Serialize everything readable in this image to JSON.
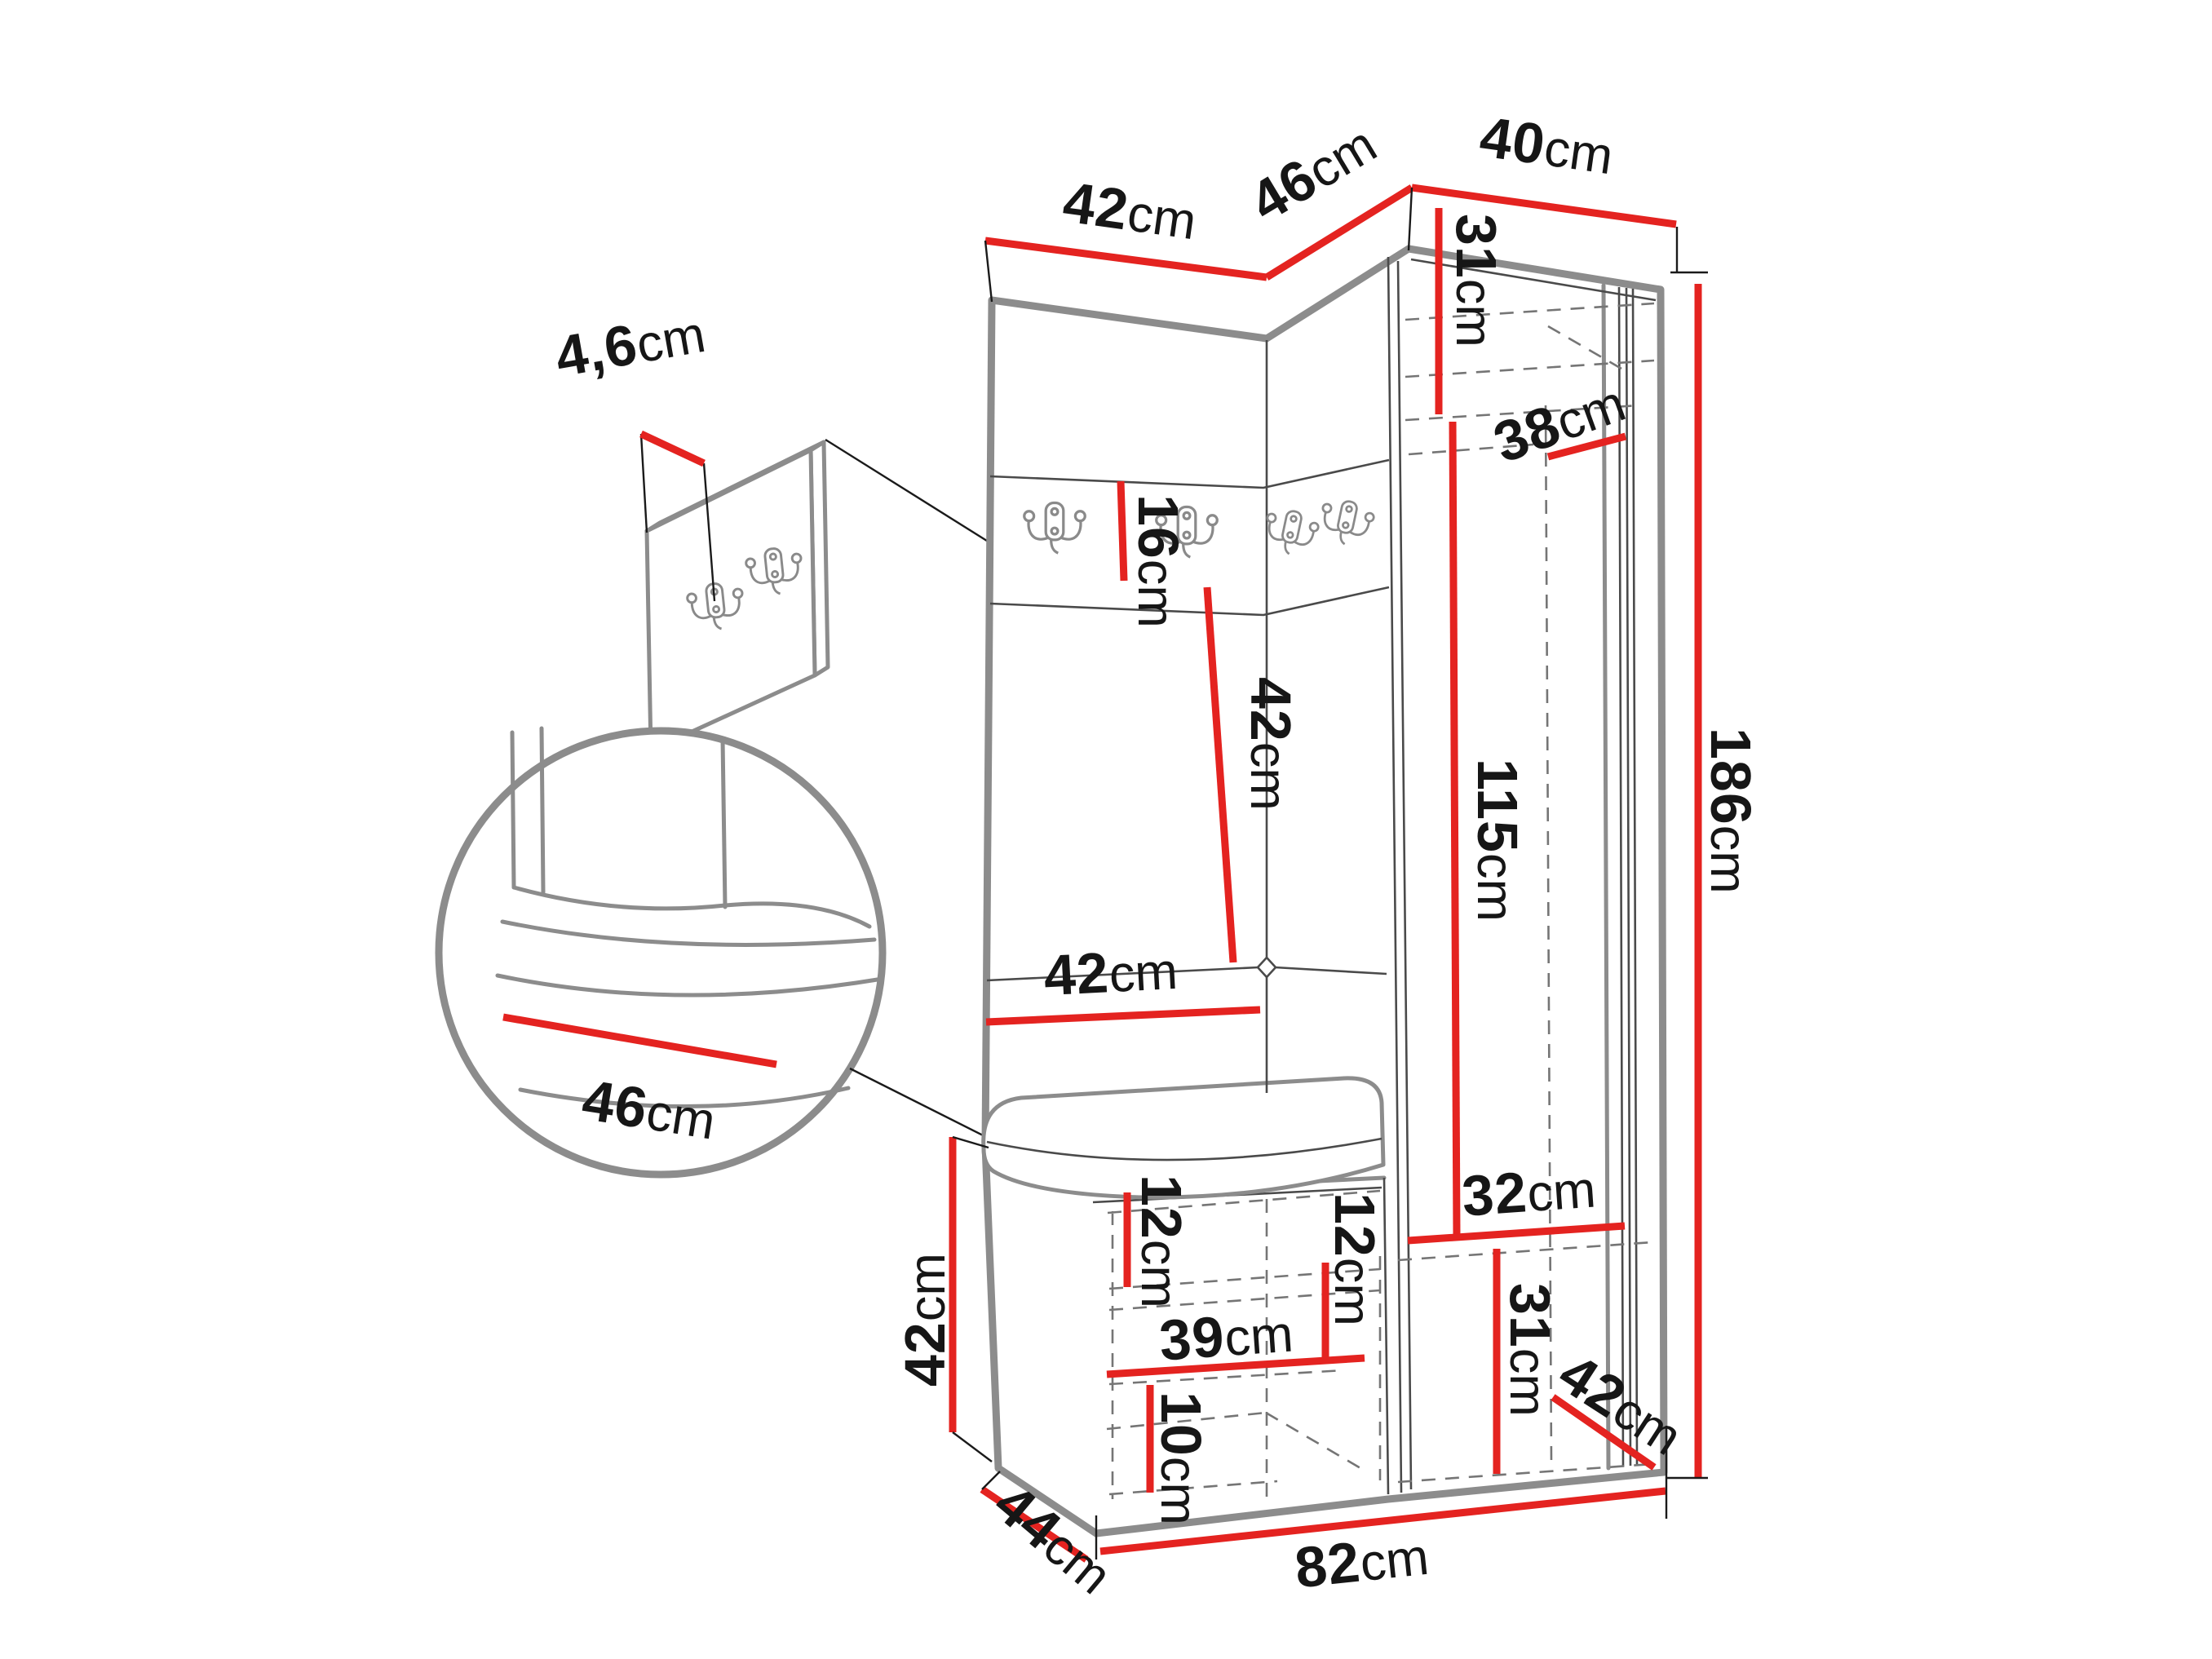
{
  "diagram": {
    "type": "furniture-dimension-drawing",
    "subject": "corner hallway wardrobe with coat hooks, bench and tall cabinet",
    "unit_suffix": "cm",
    "colors": {
      "dimension_line": "#e42320",
      "outline": "#8c8c8c",
      "detail_line": "#4a4a4a",
      "hidden_line": "#757575",
      "tick_line": "#1a1a1a",
      "label_text": "#161616",
      "background": "#ffffff"
    },
    "icons": {
      "hook": "double-coat-hook-icon",
      "detail_circle": "zoom-detail-circle"
    },
    "dimensions": {
      "top_left_section_width": {
        "value": "42",
        "unit": "cm"
      },
      "top_corner_section_width": {
        "value": "46",
        "unit": "cm"
      },
      "top_right_section_width": {
        "value": "40",
        "unit": "cm"
      },
      "hook_panel_thickness": {
        "value": "4,6",
        "unit": "cm"
      },
      "hook_rail_height": {
        "value": "16",
        "unit": "cm"
      },
      "back_panel_height": {
        "value": "42",
        "unit": "cm"
      },
      "back_panel_width": {
        "value": "42",
        "unit": "cm"
      },
      "cabinet_top_inner_height": {
        "value": "31",
        "unit": "cm"
      },
      "cabinet_inner_depth": {
        "value": "38",
        "unit": "cm"
      },
      "cabinet_inner_height": {
        "value": "115",
        "unit": "cm"
      },
      "total_height": {
        "value": "186",
        "unit": "cm"
      },
      "seat_detail_depth": {
        "value": "46",
        "unit": "cm"
      },
      "bench_height": {
        "value": "42",
        "unit": "cm"
      },
      "bench_upper_inner_height": {
        "value": "12",
        "unit": "cm"
      },
      "bench_shelf_width": {
        "value": "39",
        "unit": "cm"
      },
      "bench_lower_inner_height": {
        "value": "10",
        "unit": "cm"
      },
      "corner_shelf_inner_height": {
        "value": "12",
        "unit": "cm"
      },
      "cabinet_bottom_inner_width": {
        "value": "32",
        "unit": "cm"
      },
      "cabinet_bottom_inner_height": {
        "value": "31",
        "unit": "cm"
      },
      "cabinet_bottom_depth": {
        "value": "42",
        "unit": "cm"
      },
      "bench_depth": {
        "value": "44",
        "unit": "cm"
      },
      "base_width": {
        "value": "82",
        "unit": "cm"
      }
    }
  }
}
